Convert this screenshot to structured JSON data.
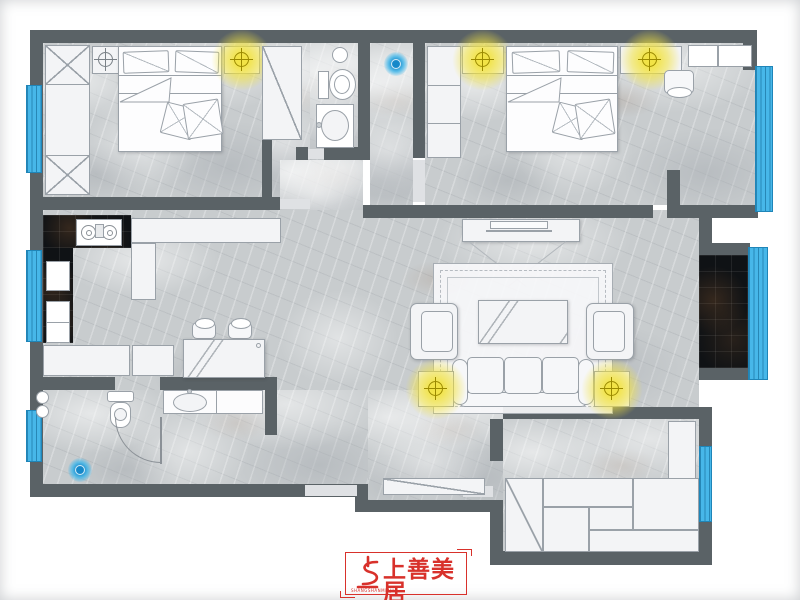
{
  "brand": {
    "name": "上善美居",
    "romanized": "SHANGSHANMEIJU",
    "color": "#d8312b"
  },
  "palette": {
    "wall": "#5a6266",
    "marble_floor": "#c8ccce",
    "dark_tile": "#0f1215",
    "window_blue": "#47b7e9",
    "window_line": "#1f85b8",
    "lamp_glow_yellow": "#f2e23c",
    "furniture_fill": "#f3f4f6",
    "furniture_line": "#9aa1a8"
  },
  "plan": {
    "type": "apartment-floor-plan",
    "glow_lamp_count": 5,
    "window_count": 6,
    "floor_drain_count": 2,
    "rooms": [
      {
        "name": "bedroom-top-left",
        "furniture": [
          "wardrobe-x-column",
          "nightstand",
          "ceiling-lamp-icon",
          "double-bed",
          "glow-lamp-icon",
          "tall-wardrobe"
        ]
      },
      {
        "name": "bathroom-top",
        "furniture": [
          "downlight",
          "toilet",
          "washbasin"
        ]
      },
      {
        "name": "hall-top",
        "furniture": [
          "floor-drain-icon"
        ]
      },
      {
        "name": "bedroom-top-right",
        "furniture": [
          "wardrobe",
          "nightstand",
          "glow-lamp-icon",
          "double-bed",
          "glow-lamp-icon",
          "stool",
          "corner-cabinets"
        ]
      },
      {
        "name": "kitchen",
        "furniture": [
          "dark-counter",
          "gas-stove",
          "sink-drainer",
          "appliance-cabinet",
          "white-counter",
          "base-cabinets"
        ]
      },
      {
        "name": "dining-nook",
        "furniture": [
          "stool",
          "stool",
          "glass-table"
        ]
      },
      {
        "name": "living-room",
        "furniture": [
          "tv-console",
          "tv-icon",
          "area-rug",
          "coffee-table",
          "armchair",
          "armchair",
          "sofa-3-seat",
          "side-table",
          "glow-lamp-icon",
          "side-table",
          "glow-lamp-icon"
        ]
      },
      {
        "name": "balcony",
        "furniture": [
          "dark-tile-floor"
        ]
      },
      {
        "name": "bathroom-bottom-left",
        "furniture": [
          "hookup-circles",
          "toilet",
          "floor-drain-icon",
          "door-arc",
          "washbasin-counter"
        ]
      },
      {
        "name": "bedroom-bottom-right",
        "furniture": [
          "shoe-cabinet",
          "tall-cabinet",
          "wardrobe-cabinet-set"
        ]
      }
    ]
  }
}
